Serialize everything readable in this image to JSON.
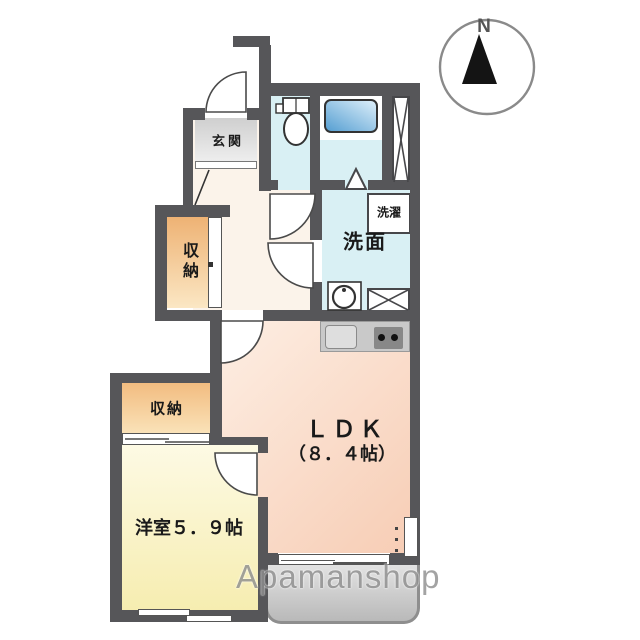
{
  "compass": {
    "label": "N"
  },
  "watermark": {
    "text": "Apamanshop"
  },
  "rooms": {
    "entrance": {
      "label": "玄関"
    },
    "hall_storage": {
      "label": "収納"
    },
    "bedroom_storage": {
      "label": "収納"
    },
    "washroom": {
      "label": "洗面"
    },
    "laundry": {
      "label": "洗濯"
    },
    "ldk": {
      "label": "ＬＤＫ",
      "size": "（８．４帖）"
    },
    "western_room": {
      "label": "洋室５．９帖"
    }
  },
  "colors": {
    "wall": "#565659",
    "wet_area_floor": "#d9f0f4",
    "bathtub": "#569fd2",
    "storage_floor": "#f2bc80",
    "western_room_floor": "#f8efb6",
    "ldk_floor": "#f9d4bd",
    "corridor_floor": "#fbf3ea",
    "entrance_floor": "#d9d9d9",
    "balcony": "#c2c2c2",
    "watermark_gray": "#8f8f8f"
  }
}
